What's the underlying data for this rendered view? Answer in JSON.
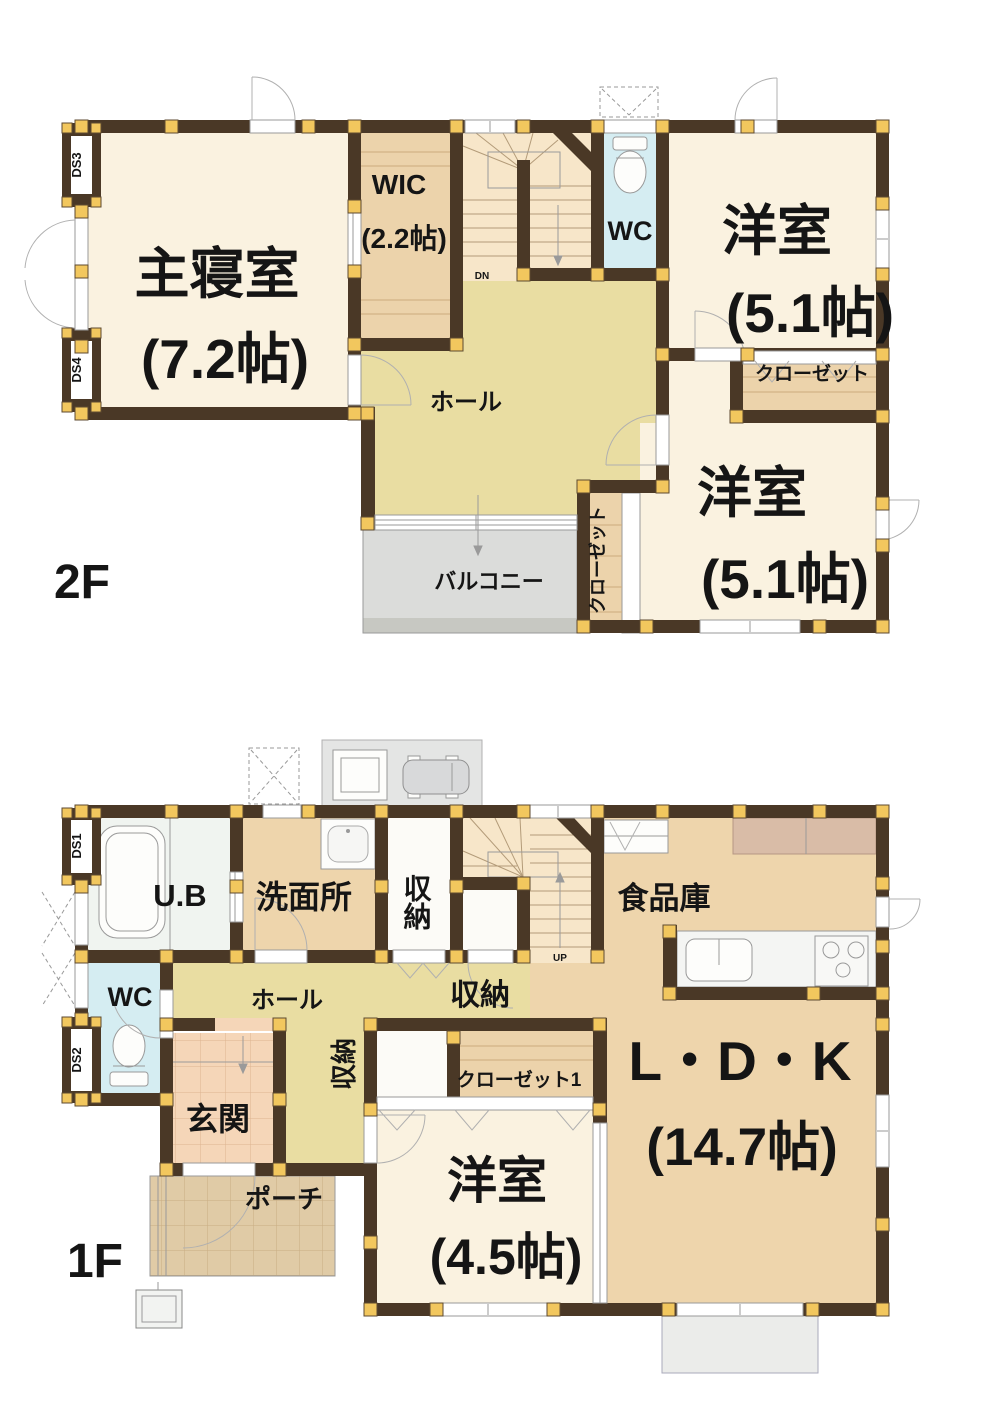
{
  "plan_title": "2-story house floor plan",
  "colors": {
    "wall": "#4a3826",
    "pillar": "#f2c75e",
    "room_cream": "#faf2e0",
    "closet_tan": "#ecd3ab",
    "hall_khaki": "#e9dda2",
    "stairs": "#f7e6c9",
    "wc_cyan": "#d5edf2",
    "ldk_tan": "#eed5ac",
    "entrance_salmon": "#f5d6b8",
    "porch_tan": "#e0cba6",
    "balcony_gray": "#dbdcda",
    "terrace_gray": "#ebecea"
  },
  "f2": {
    "label": "2F",
    "master": "主寝室",
    "master_size": "(7.2帖)",
    "wic": "WIC",
    "wic_size": "(2.2帖)",
    "wc": "WC",
    "hall": "ホール",
    "bed_ne": "洋室",
    "bed_ne_size": "(5.1帖)",
    "closet_ne": "クローゼット",
    "bed_se": "洋室",
    "bed_se_size": "(5.1帖)",
    "closet_sw": "クローゼット",
    "balcony": "バルコニー",
    "dn": "DN",
    "ds3": "DS3",
    "ds4": "DS4"
  },
  "f1": {
    "label": "1F",
    "ub": "U.B",
    "washroom": "洗面所",
    "storage_n": "収納",
    "wc": "WC",
    "hall": "ホール",
    "storage_stair": "収納",
    "storage_w": "収納",
    "pantry": "食品庫",
    "ldk": "L・D・K",
    "ldk_size": "(14.7帖)",
    "closet1": "クローゼット1",
    "bed": "洋室",
    "bed_size": "(4.5帖)",
    "entrance": "玄関",
    "porch": "ポーチ",
    "up": "UP",
    "ds1": "DS1",
    "ds2": "DS2"
  }
}
